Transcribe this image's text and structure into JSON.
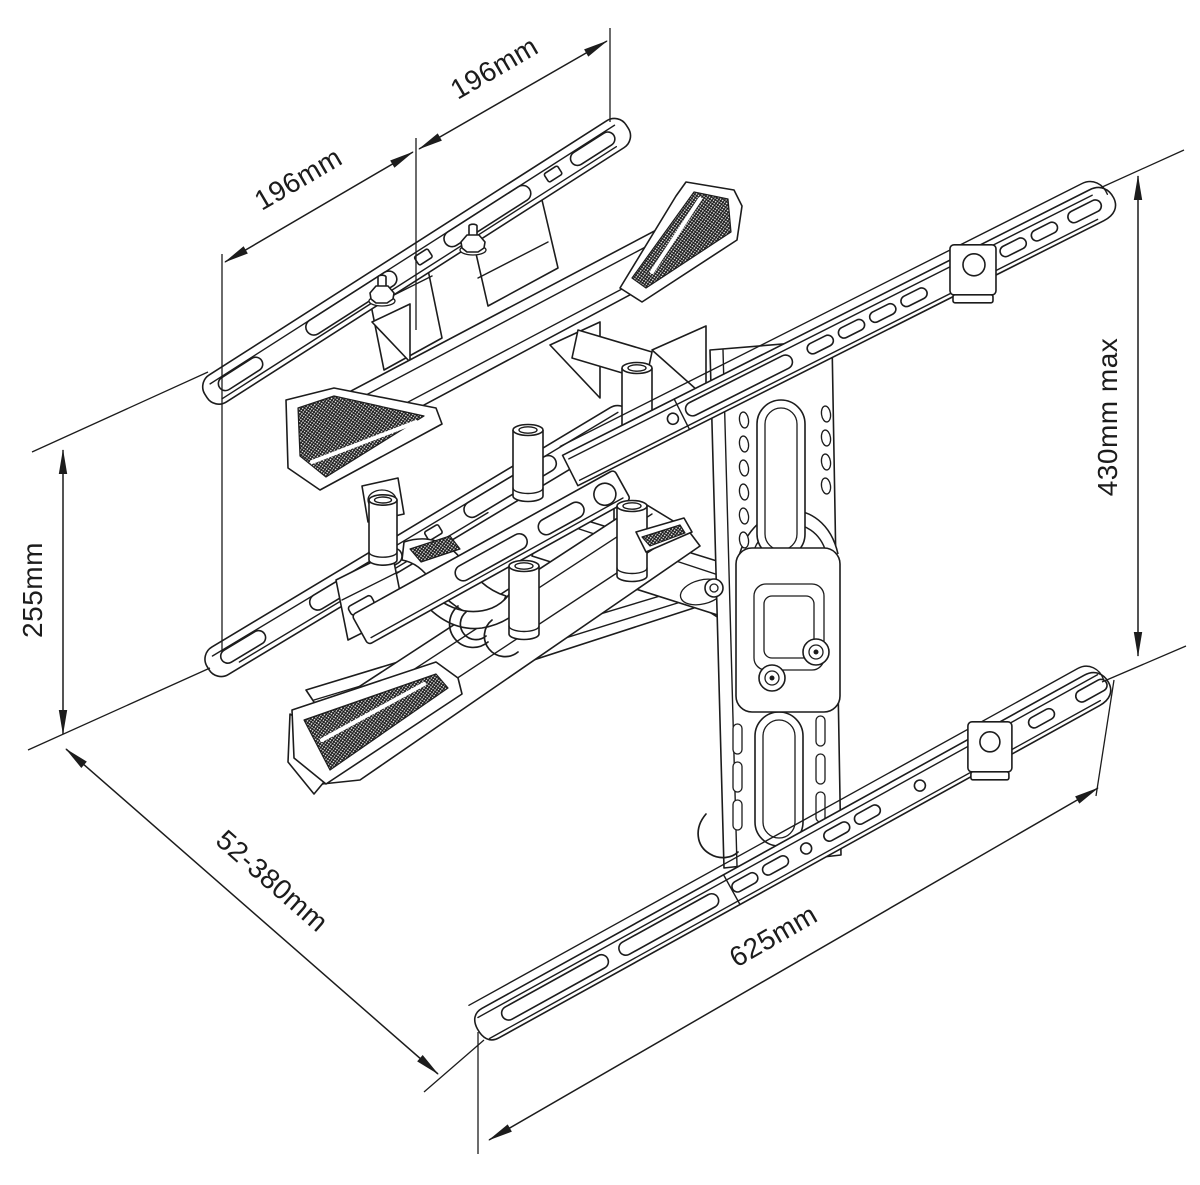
{
  "diagram": {
    "background": "#ffffff",
    "line_color": "#1c1c1c",
    "subject": "articulating-tv-wall-mount-isometric-dimension-drawing",
    "dimensions": [
      {
        "name": "vesa-hole-spacing-left",
        "label": "196mm"
      },
      {
        "name": "vesa-hole-spacing-right",
        "label": "196mm"
      },
      {
        "name": "tv-bracket-height",
        "label": "255mm"
      },
      {
        "name": "wall-plate-height",
        "label": "430mm max"
      },
      {
        "name": "extension-depth-range",
        "label": "52-380mm"
      },
      {
        "name": "wall-plate-width",
        "label": "625mm"
      }
    ]
  }
}
